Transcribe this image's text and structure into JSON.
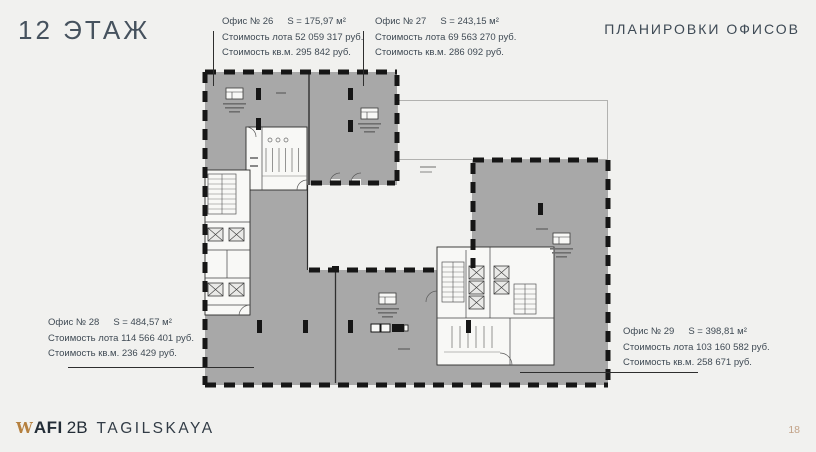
{
  "page": {
    "title": "12 ЭТАЖ",
    "heading": "ПЛАНИРОВКИ ОФИСОВ",
    "page_number": "18"
  },
  "offices": {
    "o26": {
      "name": "Офис  № 26",
      "area": "S = 175,97 м²",
      "price_lot": "Стоимость лота 52 059 317 руб.",
      "price_sqm": "Стоимость кв.м. 295 842 руб."
    },
    "o27": {
      "name": "Офис № 27",
      "area": "S = 243,15 м²",
      "price_lot": "Стоимость лота 69 563 270 руб.",
      "price_sqm": "Стоимость кв.м.  286 092 руб."
    },
    "o28": {
      "name": "Офис № 28",
      "area": "S = 484,57 м²",
      "price_lot": "Стоимость лота 114 566 401 руб.",
      "price_sqm": "Стоимость кв.м. 236 429 руб."
    },
    "o29": {
      "name": "Офис № 29",
      "area": "S = 398,81 м²",
      "price_lot": "Стоимость лота 103 160 582 руб.",
      "price_sqm": "Стоимость кв.м. 258 671 руб."
    }
  },
  "footer": {
    "brand_mark": "W",
    "brand_name": "AFI",
    "brand_suffix": "2B",
    "brand_project": "TAGILSKAYA"
  },
  "colors": {
    "background": "#f1f1ef",
    "plan_gray": "#a8a8a8",
    "wall_black": "#161616",
    "text_dark": "#3f4a54",
    "accent_gold": "#b5803f",
    "page_number_tan": "#c2a287"
  }
}
